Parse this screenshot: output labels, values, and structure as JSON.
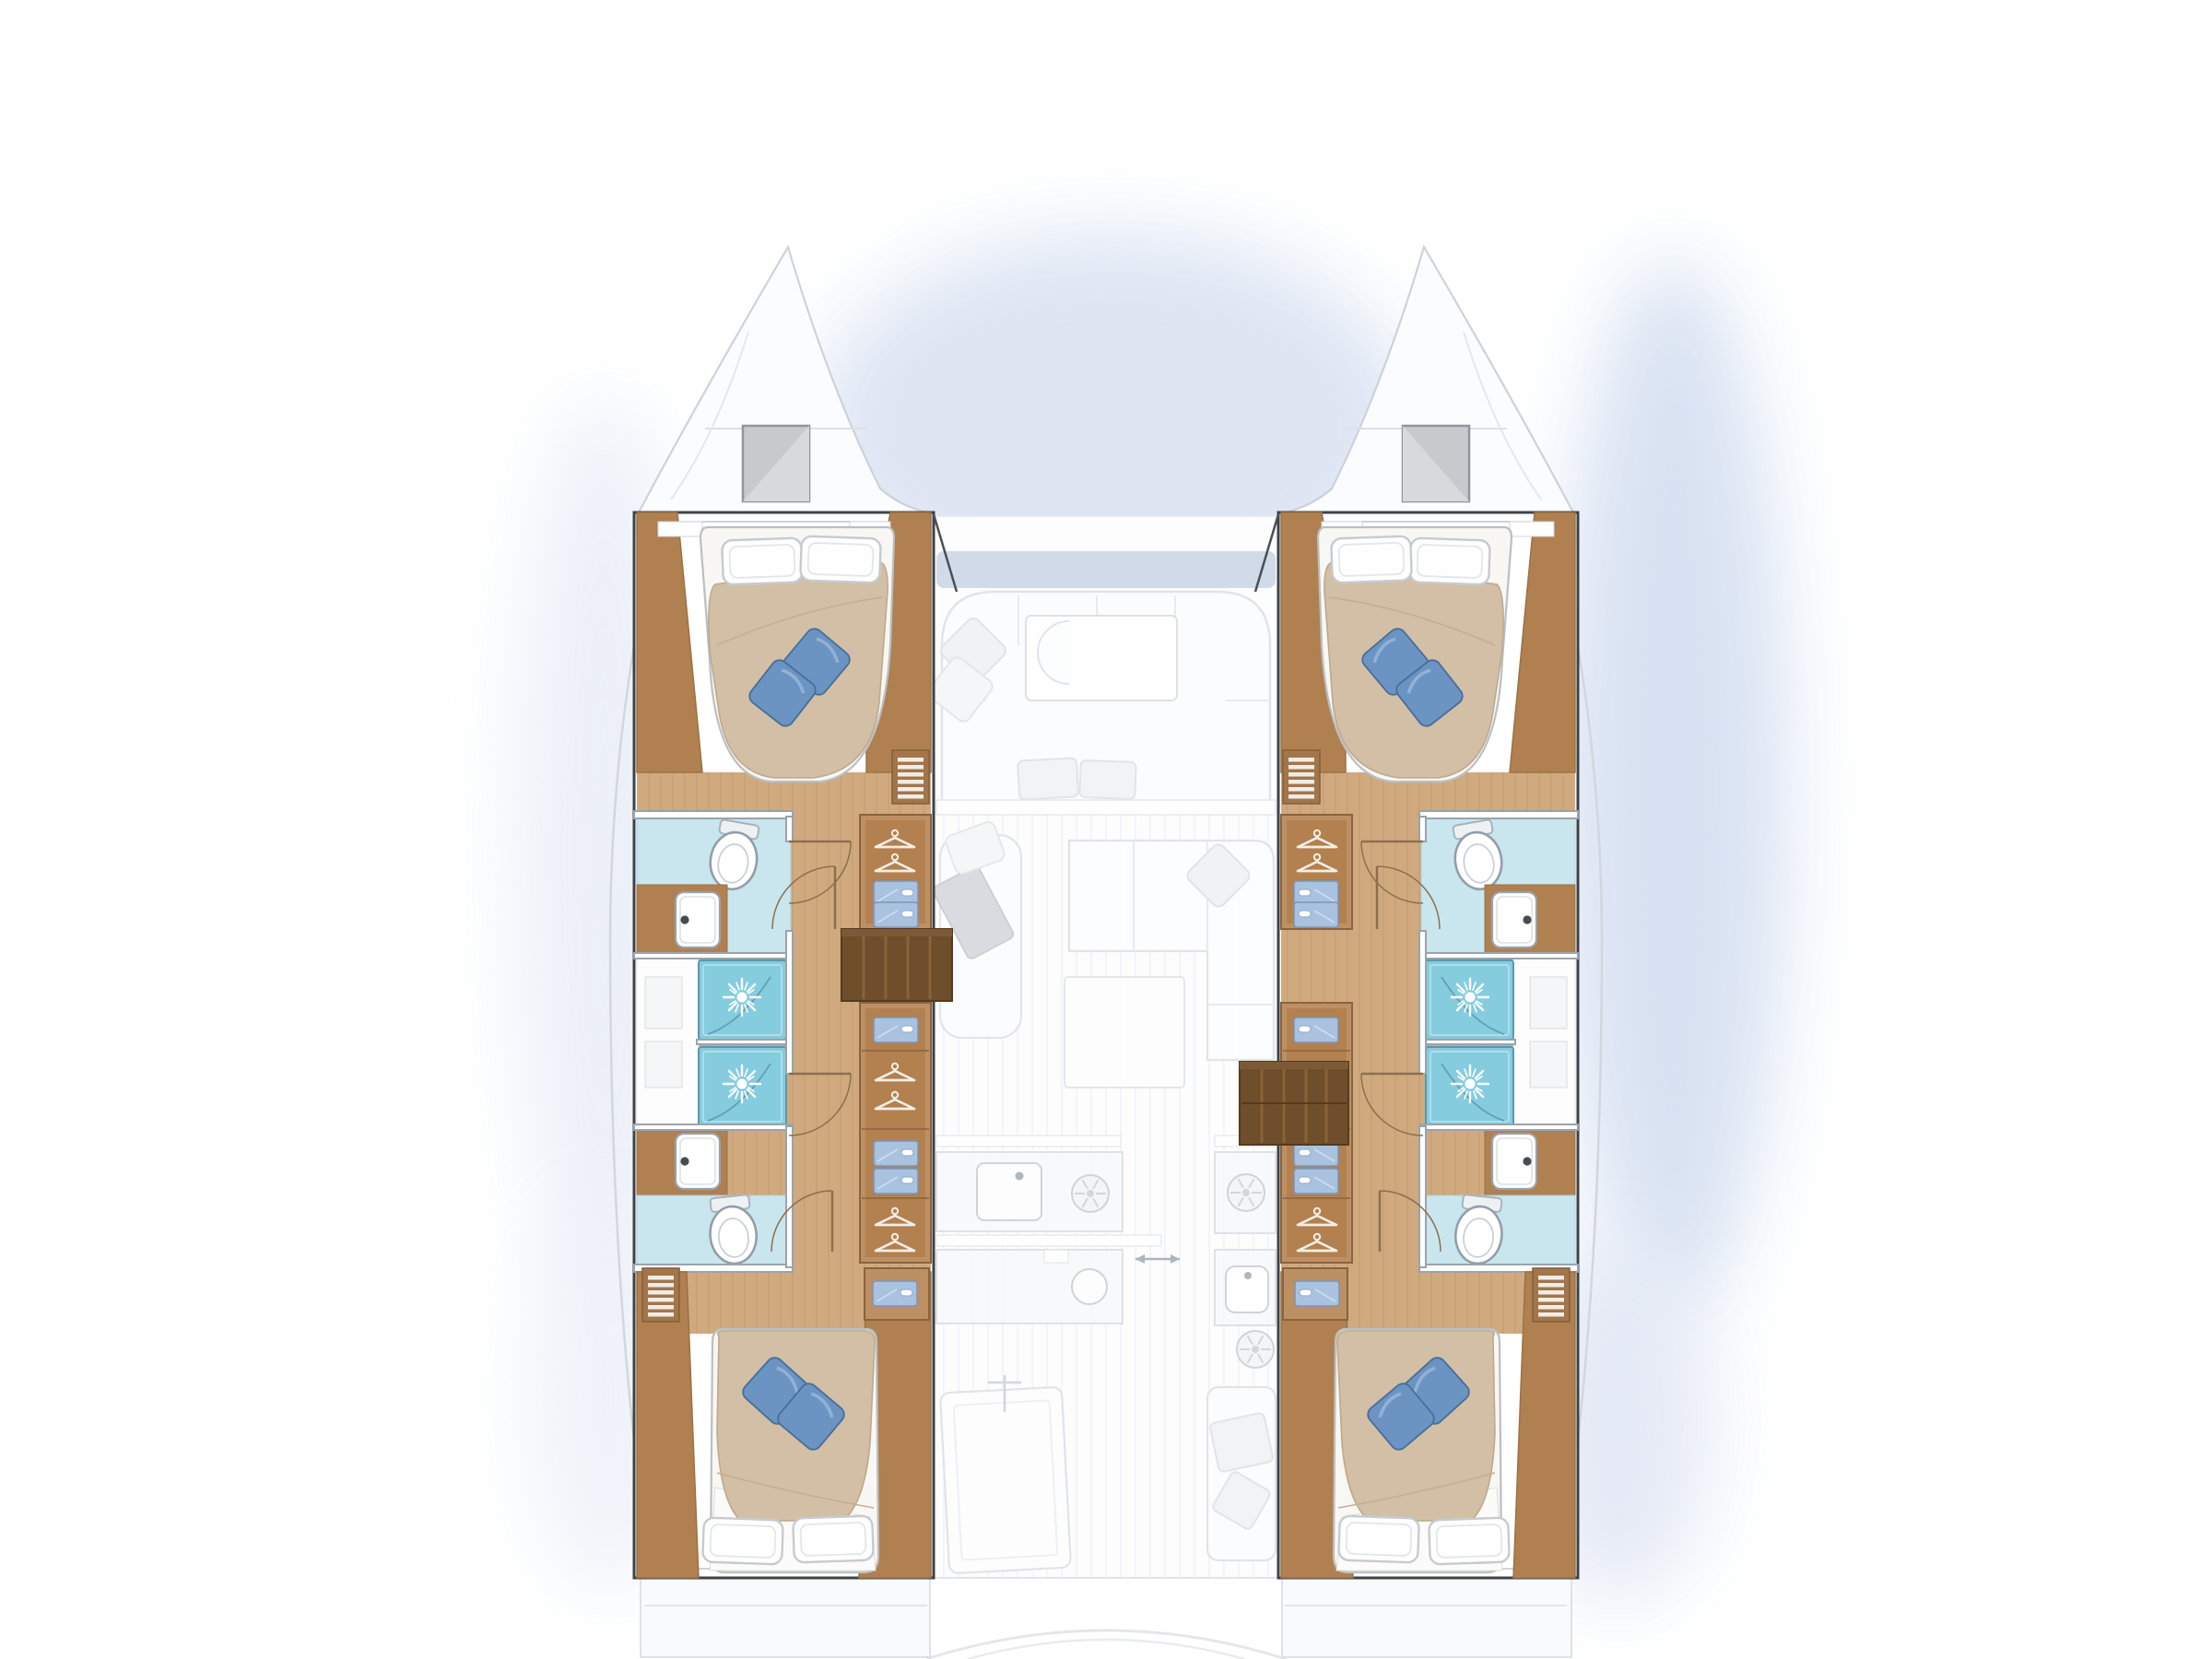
{
  "diagram": {
    "type": "floor-plan",
    "subject": "catamaran-interior-deck-plan",
    "view": "top-down",
    "orientation": "bow-up",
    "visible_text": [],
    "hulls": [
      {
        "side": "port",
        "sections": [
          {
            "name": "bow-locker",
            "fixtures": [
              "deck-hatch"
            ]
          },
          {
            "name": "forward-cabin",
            "fixtures": [
              "double-bed",
              "white-pillow",
              "white-pillow",
              "accent-pillow",
              "accent-pillow",
              "louver-vent",
              "wardrobe-hangers",
              "drawer-unit"
            ]
          },
          {
            "name": "forward-bathroom",
            "fixtures": [
              "toilet",
              "washbasin",
              "shower-stall",
              "door-swing"
            ]
          },
          {
            "name": "corridor",
            "fixtures": [
              "wardrobe-hangers",
              "drawer-unit",
              "companionway-steps",
              "door-swing"
            ]
          },
          {
            "name": "aft-bathroom",
            "fixtures": [
              "shower-stall",
              "washbasin",
              "toilet",
              "door-swing"
            ]
          },
          {
            "name": "aft-cabin",
            "fixtures": [
              "double-bed",
              "white-pillow",
              "white-pillow",
              "accent-pillow",
              "accent-pillow",
              "louver-vent",
              "nightstand-drawer"
            ]
          }
        ]
      },
      {
        "side": "starboard",
        "sections": [
          {
            "name": "bow-locker",
            "fixtures": [
              "deck-hatch"
            ]
          },
          {
            "name": "forward-cabin",
            "fixtures": [
              "double-bed",
              "white-pillow",
              "white-pillow",
              "accent-pillow",
              "accent-pillow",
              "louver-vent",
              "wardrobe-hangers",
              "drawer-unit"
            ]
          },
          {
            "name": "forward-bathroom",
            "fixtures": [
              "toilet",
              "washbasin",
              "shower-stall",
              "door-swing"
            ]
          },
          {
            "name": "corridor",
            "fixtures": [
              "wardrobe-hangers",
              "drawer-unit",
              "companionway-steps",
              "door-swing"
            ]
          },
          {
            "name": "aft-bathroom",
            "fixtures": [
              "shower-stall",
              "washbasin",
              "toilet",
              "door-swing"
            ]
          },
          {
            "name": "aft-cabin",
            "fixtures": [
              "double-bed",
              "white-pillow",
              "white-pillow",
              "accent-pillow",
              "accent-pillow",
              "louver-vent",
              "nightstand-drawer"
            ]
          }
        ]
      }
    ],
    "center_deck": {
      "sections": [
        {
          "name": "foredeck",
          "fixtures": []
        },
        {
          "name": "forward-cockpit",
          "fixtures": [
            "u-shaped-sofa",
            "coffee-table",
            "c-bench",
            "cushions"
          ]
        },
        {
          "name": "saloon",
          "fixtures": [
            "l-shaped-sofa",
            "chaise-lounge",
            "side-table",
            "saloon-table",
            "cushions"
          ]
        },
        {
          "name": "galley",
          "fixtures": [
            "counter",
            "rect-sink",
            "stove-burner",
            "round-sink",
            "counter",
            "stove-burner",
            "square-sink",
            "stove-burner",
            "sliding-door-arrows"
          ]
        },
        {
          "name": "aft-cockpit",
          "fixtures": [
            "cockpit-table",
            "bench-seat",
            "transom-steps"
          ]
        }
      ]
    }
  },
  "palette": {
    "background": "#ffffff",
    "glow_blue": "#dce4f3",
    "hull_outline": "#3d4247",
    "faded_line": "#d6dade",
    "wood_floor": "#d0aa7e",
    "wood_plank_line": "#bb9167",
    "wood_trim": "#b08050",
    "wood_cabinet": "#bd9064",
    "steps_wood": "#6f4e2c",
    "tile_blue": "#c9e6ef",
    "shower_blue": "#85ccdf",
    "duvet_beige": "#d2bfa5",
    "bed_white": "#f8f7f4",
    "pillow_blue": "#6b94c3",
    "drawer_blue": "#a9c2e0",
    "fixture_white": "#ffffff",
    "fixture_stroke": "#98a2ac"
  },
  "icons": [
    "deck-hatch",
    "double-bed",
    "white-pillow",
    "accent-pillow",
    "shower-stall",
    "shower-spray",
    "toilet",
    "washbasin",
    "faucet-dot",
    "clothes-hanger",
    "drawer-unit",
    "louver-vent",
    "companionway-steps",
    "door-swing",
    "stove-burner",
    "rect-sink",
    "round-sink",
    "square-sink",
    "sliding-door-arrows",
    "cockpit-table",
    "bench-seat",
    "transom-steps"
  ]
}
